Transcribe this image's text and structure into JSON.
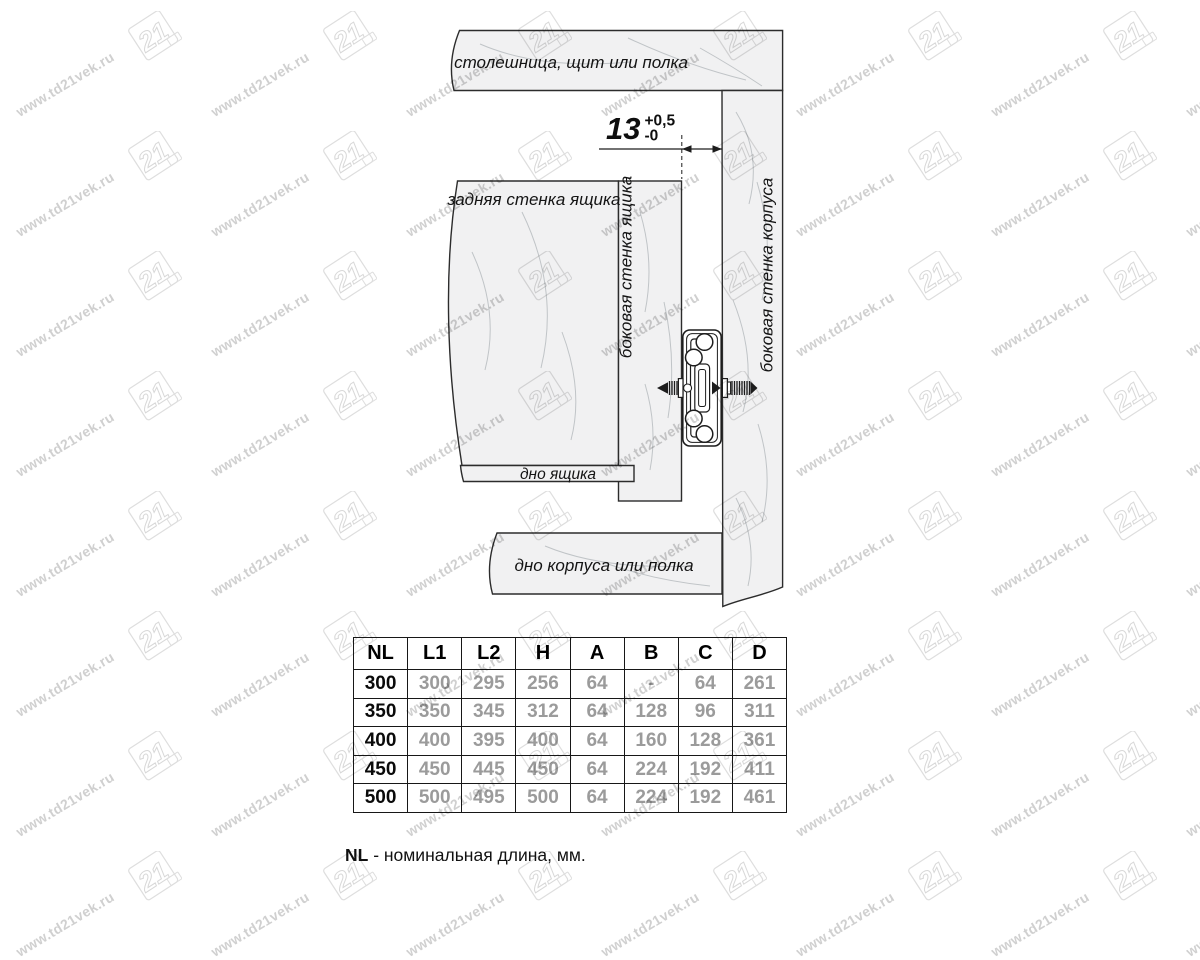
{
  "diagram": {
    "labels": {
      "top_board": "столешница, щит или полка",
      "back_wall": "задняя стенка ящика",
      "drawer_side_wall": "боковая стенка ящика",
      "cabinet_side_wall": "боковая стенка корпуса",
      "drawer_bottom": "дно ящика",
      "cabinet_bottom": "дно корпуса или полка"
    },
    "dimension": {
      "value": "13",
      "tolerance_plus": "+0,5",
      "tolerance_minus": "-0",
      "units": "mm"
    }
  },
  "table": {
    "headers": [
      "NL",
      "L1",
      "L2",
      "H",
      "A",
      "B",
      "C",
      "D"
    ],
    "rows": [
      [
        "300",
        "300",
        "295",
        "256",
        "64",
        "-",
        "64",
        "261"
      ],
      [
        "350",
        "350",
        "345",
        "312",
        "64",
        "128",
        "96",
        "311"
      ],
      [
        "400",
        "400",
        "395",
        "400",
        "64",
        "160",
        "128",
        "361"
      ],
      [
        "450",
        "450",
        "445",
        "450",
        "64",
        "224",
        "192",
        "411"
      ],
      [
        "500",
        "500",
        "495",
        "500",
        "64",
        "224",
        "192",
        "461"
      ]
    ]
  },
  "footnote": {
    "term": "NL",
    "text": " - номинальная длина, мм."
  },
  "watermark": {
    "url_text": "www.td21vek.ru",
    "logo_text": "21"
  },
  "colors": {
    "line": "#1d1d1d",
    "panel_fill": "#f1f1f2",
    "value_gray": "#9b9b9b",
    "watermark": "#d0d0d0"
  }
}
